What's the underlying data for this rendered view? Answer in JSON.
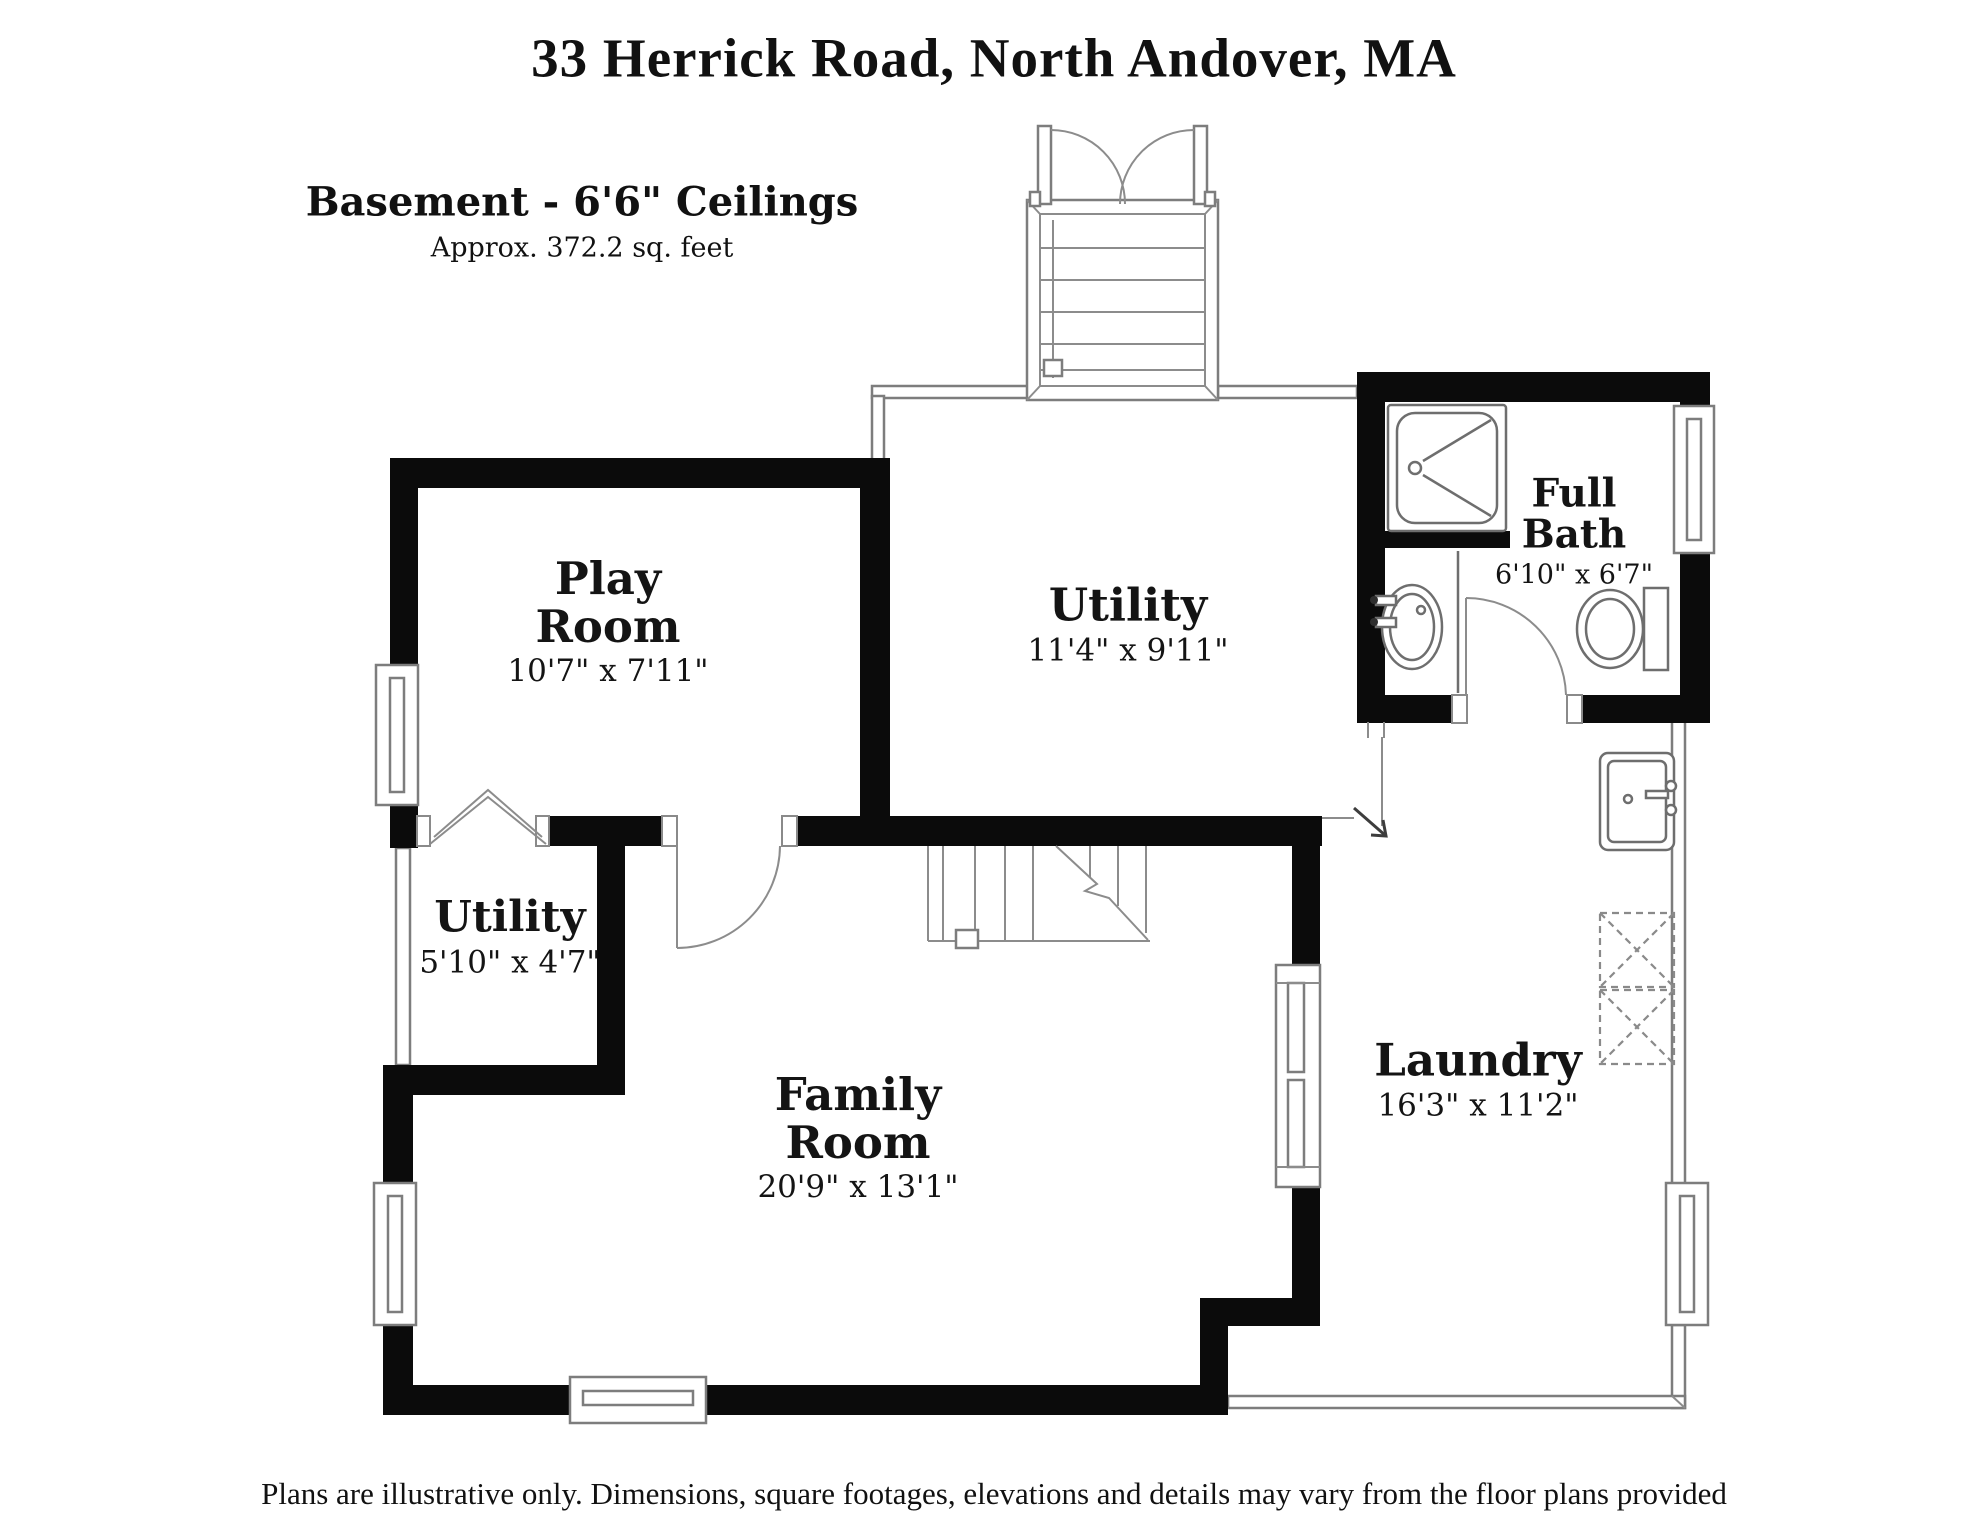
{
  "header": {
    "title": "33 Herrick Road, North Andover, MA",
    "subtitle": "Basement - 6'6\" Ceilings",
    "area": "Approx. 372.2 sq. feet"
  },
  "rooms": {
    "play_room": {
      "line1": "Play",
      "line2": "Room",
      "dims": "10'7\" x 7'11\""
    },
    "utility_main": {
      "line1": "Utility",
      "dims": "11'4\" x 9'11\""
    },
    "full_bath": {
      "line1": "Full",
      "line2": "Bath",
      "dims": "6'10\" x 6'7\""
    },
    "utility_small": {
      "line1": "Utility",
      "dims": "5'10\" x 4'7\""
    },
    "family_room": {
      "line1": "Family",
      "line2": "Room",
      "dims": "20'9\" x 13'1\""
    },
    "laundry": {
      "line1": "Laundry",
      "dims": "16'3\" x 11'2\""
    }
  },
  "footer": {
    "disclaimer": "Plans are illustrative only. Dimensions, square footages, elevations and details may vary from the floor plans provided"
  },
  "symbols": {
    "bulkhead": "bulkhead-entry-stairs",
    "interior_stairs": "staircase",
    "entry_arrow": "direction-arrow",
    "bifold": "bifold-door",
    "doors": "door-swing",
    "windows": "window",
    "shower": "shower-stall",
    "bath_sink": "sink",
    "toilet": "toilet",
    "laundry_sink": "laundry-sink",
    "washer_dryer": "washer-dryer-dashed"
  },
  "colors": {
    "wall": "#0b0b0b",
    "thin_line": "#7d7d7d",
    "background": "#ffffff",
    "text": "#141414"
  }
}
